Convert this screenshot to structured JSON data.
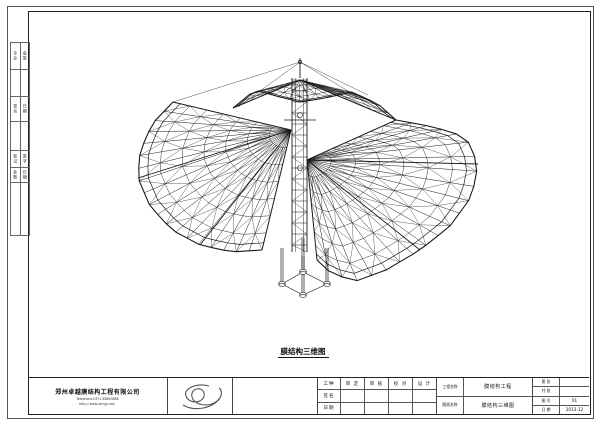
{
  "sheet": {
    "caption": "膜结构三维图",
    "countersign": {
      "groups": [
        [
          "专业",
          "会签"
        ],
        [
          "签名",
          "日期"
        ],
        [
          "标记",
          "签字"
        ],
        [
          "处数",
          "日期"
        ]
      ]
    },
    "title_block": {
      "company": {
        "name": "郑州卓越膜结构工程有限公司",
        "telephone": "Telephone:0371-88643888",
        "website": "http:// www.zzmjg.com"
      },
      "logo_icon": "swirl-calligraphy-logo",
      "signature_grid": {
        "row1_label": "工种",
        "col_headers": [
          "审 定",
          "审 核",
          "校 对",
          "设 计"
        ],
        "row2_label": "签名",
        "row3_label": "日期"
      },
      "project": {
        "name_label": "工程名称",
        "name_value": "膜结构工程",
        "drawing_label": "图纸名称",
        "drawing_value": "膜结构三维图"
      },
      "info_rows": [
        {
          "label": "第 张",
          "value": ""
        },
        {
          "label": "共 张",
          "value": ""
        },
        {
          "label": "图 号",
          "value": "01"
        },
        {
          "label": "日 期",
          "value": "2013-12"
        }
      ]
    },
    "line_color": "#1a1a1a",
    "drawing_subject": "membrane-structure-3d-wireframe"
  }
}
